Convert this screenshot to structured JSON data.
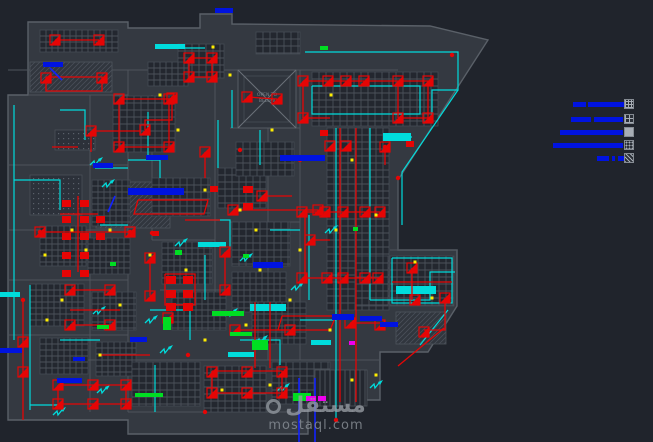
{
  "watermark": {
    "logo": "مستقل",
    "url": "mostaql.com"
  },
  "void_label": {
    "line1": "OPEN TO",
    "line2": "BELOW"
  },
  "palette": {
    "bg": "#20242c",
    "building": "#343941",
    "wall": "#5a6068",
    "wall_dim": "#4e545c",
    "grid_fill": "#23272f",
    "grid_line": "#4b515a",
    "red": "#e60505",
    "cyan": "#00dcdc",
    "blue": "#0013e0",
    "yellow": "#ffee00",
    "green": "#00dd22",
    "magenta": "#ee00ee",
    "gray_text": "#788089"
  },
  "legend": {
    "rows": [
      {
        "bars": [
          [
            573,
            102,
            13,
            5
          ],
          [
            588,
            102,
            36,
            5
          ]
        ],
        "swatch": {
          "x": 624,
          "y": 99,
          "pattern": "fine-grid"
        }
      },
      {
        "bars": [
          [
            571,
            117,
            20,
            5
          ],
          [
            594,
            117,
            29,
            5
          ]
        ],
        "swatch": {
          "x": 624,
          "y": 114,
          "pattern": "coarse-grid"
        }
      },
      {
        "bars": [
          [
            560,
            130,
            63,
            5
          ]
        ],
        "swatch": {
          "x": 624,
          "y": 127,
          "pattern": "solid"
        }
      },
      {
        "bars": [
          [
            553,
            143,
            70,
            5
          ]
        ],
        "swatch": {
          "x": 624,
          "y": 140,
          "pattern": "speckle"
        }
      },
      {
        "bars": [
          [
            597,
            156,
            12,
            5
          ],
          [
            612,
            156,
            3,
            5
          ],
          [
            618,
            156,
            12,
            5
          ]
        ],
        "swatch": {
          "x": 624,
          "y": 153,
          "pattern": "diag"
        }
      }
    ]
  },
  "drawing": {
    "building": [
      {
        "pts": "28,22 128,22 128,28 200,28 200,14 232,14 232,24 430,26 488,40 398,180 398,250 457,250 457,306 428,352 380,352 380,400 308,400 308,434 128,434 128,420 8,420 8,95 28,95"
      }
    ],
    "walls": [
      [
        128,
        70,
        128,
        412
      ],
      [
        90,
        95,
        90,
        412
      ],
      [
        152,
        95,
        152,
        240
      ],
      [
        215,
        70,
        215,
        300
      ],
      [
        268,
        128,
        268,
        360
      ],
      [
        300,
        70,
        300,
        360
      ],
      [
        8,
        165,
        128,
        165
      ],
      [
        8,
        230,
        128,
        230
      ],
      [
        8,
        280,
        128,
        280
      ],
      [
        8,
        335,
        128,
        335
      ],
      [
        60,
        360,
        380,
        360
      ],
      [
        128,
        412,
        300,
        412
      ],
      [
        152,
        240,
        215,
        240
      ],
      [
        230,
        128,
        300,
        128
      ],
      [
        230,
        222,
        300,
        222
      ],
      [
        160,
        290,
        230,
        290
      ],
      [
        8,
        70,
        398,
        70
      ],
      [
        28,
        95,
        128,
        95
      ],
      [
        398,
        180,
        398,
        250
      ],
      [
        390,
        250,
        457,
        250
      ]
    ],
    "grids": [
      [
        40,
        30,
        78,
        22,
        6
      ],
      [
        178,
        44,
        46,
        34,
        7
      ],
      [
        256,
        32,
        44,
        22,
        7
      ],
      [
        148,
        62,
        40,
        24,
        6
      ],
      [
        312,
        72,
        126,
        54,
        7
      ],
      [
        327,
        128,
        62,
        182,
        7
      ],
      [
        390,
        256,
        64,
        50,
        7
      ],
      [
        355,
        256,
        33,
        50,
        7
      ],
      [
        113,
        96,
        62,
        56,
        7
      ],
      [
        92,
        180,
        38,
        46,
        6
      ],
      [
        40,
        226,
        46,
        40,
        6
      ],
      [
        88,
        238,
        42,
        36,
        6
      ],
      [
        30,
        284,
        54,
        42,
        6
      ],
      [
        92,
        292,
        44,
        38,
        6
      ],
      [
        40,
        338,
        48,
        36,
        6
      ],
      [
        96,
        342,
        40,
        34,
        6
      ],
      [
        152,
        178,
        58,
        38,
        7
      ],
      [
        218,
        168,
        48,
        40,
        7
      ],
      [
        236,
        142,
        58,
        34,
        7
      ],
      [
        232,
        222,
        58,
        44,
        7
      ],
      [
        162,
        242,
        50,
        42,
        6
      ],
      [
        232,
        272,
        54,
        40,
        6
      ],
      [
        172,
        292,
        54,
        38,
        6
      ],
      [
        252,
        302,
        54,
        42,
        6
      ],
      [
        132,
        362,
        68,
        44,
        7
      ],
      [
        204,
        366,
        62,
        46,
        7
      ],
      [
        272,
        362,
        58,
        42,
        7
      ]
    ],
    "hatches": [
      [
        96,
        182,
        74,
        46
      ],
      [
        30,
        62,
        82,
        30
      ],
      [
        396,
        312,
        50,
        32
      ]
    ],
    "dotregions": [
      [
        30,
        175,
        52,
        40
      ],
      [
        55,
        130,
        40,
        20
      ]
    ],
    "stripes": [
      [
        315,
        370,
        52,
        36
      ]
    ],
    "xroom": {
      "x": 238,
      "y": 70,
      "w": 58,
      "h": 58
    },
    "redlines": [
      "55,40 99,40",
      "46,77 102,77 102,91 46,91 46,77",
      "119,99 169,99 169,147 119,147 119,99",
      "189,58 212,58 212,77 189,77 189,58",
      "303,81 432,81",
      "303,81 303,118",
      "398,81 398,118",
      "428,81 428,118",
      "303,118 330,118",
      "398,118 428,118",
      "340,128 340,402",
      "356,128 356,402",
      "302,212 380,212",
      "302,278 380,278",
      "305,212 305,278",
      "172,98 172,120 145,120 145,130",
      "92,131 140,131",
      "40,232 130,232",
      "78,196 78,272",
      "60,214 98,214",
      "58,385 126,385 126,404 58,404 58,385",
      "212,371 282,371 282,393 212,393 212,371",
      "23,300 23,420",
      "247,97 277,99",
      "233,210 318,210",
      "165,274 195,274 195,305 165,305 165,274",
      "398,366 444,328",
      "412,268 412,300",
      "392,282 452,282",
      "52,147 78,147",
      "150,258 150,296",
      "205,152 205,178",
      "262,196 292,196",
      "70,310 120,310",
      "100,355 150,355",
      "235,330 290,330",
      "310,240 330,240",
      "225,252 225,290",
      "185,220 220,220",
      "445,298 445,330 424,330",
      "350,323 382,323",
      "255,302 255,368",
      "270,302 270,368",
      "138,200 208,200 204,214 134,214 138,200",
      "282,316 336,316 330,330 278,330 282,316",
      "70,290 110,290",
      "70,325 110,325",
      "91,131 91,152",
      "385,147 385,165"
    ],
    "fixtures": [
      [
        55,
        40
      ],
      [
        99,
        40
      ],
      [
        46,
        78
      ],
      [
        102,
        78
      ],
      [
        119,
        99
      ],
      [
        169,
        99
      ],
      [
        119,
        147
      ],
      [
        169,
        147
      ],
      [
        189,
        58
      ],
      [
        212,
        58
      ],
      [
        189,
        77
      ],
      [
        212,
        77
      ],
      [
        303,
        81
      ],
      [
        328,
        81
      ],
      [
        346,
        81
      ],
      [
        364,
        81
      ],
      [
        398,
        81
      ],
      [
        428,
        81
      ],
      [
        303,
        118
      ],
      [
        398,
        118
      ],
      [
        428,
        118
      ],
      [
        330,
        146
      ],
      [
        346,
        146
      ],
      [
        302,
        212
      ],
      [
        325,
        212
      ],
      [
        343,
        212
      ],
      [
        365,
        212
      ],
      [
        380,
        212
      ],
      [
        302,
        278
      ],
      [
        327,
        278
      ],
      [
        343,
        278
      ],
      [
        365,
        278
      ],
      [
        378,
        278
      ],
      [
        412,
        268
      ],
      [
        415,
        300
      ],
      [
        445,
        298
      ],
      [
        424,
        332
      ],
      [
        350,
        323
      ],
      [
        380,
        325
      ],
      [
        172,
        98
      ],
      [
        145,
        130
      ],
      [
        91,
        131
      ],
      [
        247,
        97
      ],
      [
        277,
        99
      ],
      [
        70,
        290
      ],
      [
        110,
        290
      ],
      [
        70,
        325
      ],
      [
        110,
        325
      ],
      [
        58,
        385
      ],
      [
        93,
        385
      ],
      [
        126,
        385
      ],
      [
        58,
        404
      ],
      [
        93,
        404
      ],
      [
        126,
        404
      ],
      [
        212,
        372
      ],
      [
        247,
        372
      ],
      [
        282,
        372
      ],
      [
        212,
        393
      ],
      [
        247,
        393
      ],
      [
        282,
        393
      ],
      [
        205,
        152
      ],
      [
        262,
        196
      ],
      [
        150,
        258
      ],
      [
        150,
        296
      ],
      [
        225,
        252
      ],
      [
        225,
        290
      ],
      [
        310,
        240
      ],
      [
        290,
        330
      ],
      [
        235,
        330
      ],
      [
        23,
        342
      ],
      [
        23,
        372
      ],
      [
        40,
        232
      ],
      [
        130,
        232
      ],
      [
        385,
        147
      ],
      [
        168,
        318
      ],
      [
        233,
        210
      ],
      [
        318,
        210
      ]
    ],
    "panels": [
      [
        62,
        200,
        9,
        7
      ],
      [
        80,
        200,
        9,
        7
      ],
      [
        62,
        216,
        9,
        7
      ],
      [
        80,
        216,
        9,
        7
      ],
      [
        96,
        216,
        9,
        7
      ],
      [
        62,
        233,
        9,
        7
      ],
      [
        80,
        233,
        9,
        7
      ],
      [
        96,
        233,
        9,
        7
      ],
      [
        62,
        252,
        9,
        7
      ],
      [
        80,
        252,
        9,
        7
      ],
      [
        62,
        270,
        9,
        7
      ],
      [
        80,
        270,
        9,
        7
      ],
      [
        166,
        276,
        10,
        8
      ],
      [
        183,
        276,
        10,
        8
      ],
      [
        166,
        290,
        10,
        8
      ],
      [
        183,
        290,
        10,
        8
      ],
      [
        166,
        303,
        10,
        8
      ],
      [
        183,
        303,
        10,
        8
      ],
      [
        243,
        186,
        10,
        7
      ],
      [
        243,
        203,
        10,
        7
      ],
      [
        320,
        130,
        8,
        6
      ],
      [
        406,
        141,
        8,
        6
      ],
      [
        152,
        231,
        7,
        5
      ],
      [
        210,
        186,
        8,
        6
      ]
    ],
    "cyanlines": [
      "305,52 458,52 458,90 432,90 432,120",
      "458,90 402,172 402,225",
      "312,86 420,86 420,114 312,114 312,86",
      "336,128 336,400",
      "370,128 370,300",
      "370,300 430,300 430,272 455,272",
      "392,258 452,258 452,303 392,303 392,258",
      "14,105 14,340",
      "30,285 30,410",
      "14,180 60,180 60,210",
      "128,160 160,160 160,178",
      "95,168 128,168",
      "148,112 148,160",
      "218,120 218,168",
      "260,130 260,165",
      "200,220 230,220 230,250",
      "150,310 190,310 190,340",
      "60,340 100,340",
      "240,340 280,340 280,365",
      "300,320 336,320",
      "386,137 412,137",
      "60,110 85,110 85,140",
      "175,48 205,48",
      "100,225 128,225",
      "309,215 309,300",
      "448,310 420,345",
      "270,230 300,230",
      "155,365 155,412",
      "30,405 58,405",
      "205,255 205,300",
      "336,400 336,420",
      "232,90 232,128"
    ],
    "cyanbars": [
      [
        383,
        133,
        28,
        8
      ],
      [
        396,
        286,
        40,
        8
      ],
      [
        250,
        304,
        36,
        7
      ],
      [
        198,
        242,
        28,
        5
      ],
      [
        311,
        340,
        20,
        5
      ],
      [
        0,
        292,
        20,
        5
      ],
      [
        155,
        44,
        30,
        5
      ],
      [
        228,
        352,
        26,
        5
      ]
    ],
    "squiggles": [
      [
        107,
        184
      ],
      [
        180,
        243
      ],
      [
        245,
        258
      ],
      [
        296,
        287
      ],
      [
        330,
        230
      ],
      [
        98,
        311
      ],
      [
        150,
        320
      ],
      [
        230,
        313
      ],
      [
        375,
        385
      ],
      [
        282,
        388
      ],
      [
        102,
        390
      ],
      [
        58,
        412
      ],
      [
        165,
        350
      ],
      [
        260,
        340
      ],
      [
        95,
        162
      ]
    ],
    "bluebars": [
      [
        43,
        62,
        20,
        5
      ],
      [
        128,
        188,
        56,
        7
      ],
      [
        146,
        155,
        22,
        5
      ],
      [
        93,
        163,
        20,
        5
      ],
      [
        280,
        155,
        45,
        6
      ],
      [
        332,
        314,
        22,
        6
      ],
      [
        360,
        316,
        22,
        5
      ],
      [
        380,
        322,
        18,
        5
      ],
      [
        0,
        348,
        22,
        5
      ],
      [
        73,
        357,
        12,
        4
      ],
      [
        57,
        378,
        25,
        5
      ],
      [
        130,
        337,
        17,
        5
      ],
      [
        215,
        8,
        18,
        5
      ],
      [
        253,
        262,
        30,
        6
      ]
    ],
    "bluelines": [
      "299,378 299,442",
      "315,378 315,442",
      "50,68 62,80",
      "115,196 108,212"
    ],
    "yellowdots": [
      [
        213,
        47
      ],
      [
        230,
        75
      ],
      [
        331,
        95
      ],
      [
        272,
        130
      ],
      [
        352,
        160
      ],
      [
        376,
        215
      ],
      [
        336,
        230
      ],
      [
        300,
        250
      ],
      [
        62,
        300
      ],
      [
        100,
        355
      ],
      [
        246,
        325
      ],
      [
        352,
        380
      ],
      [
        376,
        375
      ],
      [
        270,
        385
      ],
      [
        222,
        390
      ],
      [
        120,
        305
      ],
      [
        47,
        320
      ],
      [
        150,
        255
      ],
      [
        186,
        270
      ],
      [
        205,
        190
      ],
      [
        256,
        230
      ],
      [
        290,
        300
      ],
      [
        432,
        298
      ],
      [
        415,
        262
      ],
      [
        86,
        250
      ],
      [
        178,
        130
      ],
      [
        160,
        95
      ],
      [
        240,
        210
      ],
      [
        330,
        330
      ],
      [
        205,
        340
      ],
      [
        260,
        270
      ],
      [
        110,
        230
      ],
      [
        72,
        230
      ],
      [
        45,
        255
      ]
    ],
    "greens": [
      [
        175,
        250,
        7,
        5
      ],
      [
        243,
        254,
        6,
        4
      ],
      [
        212,
        311,
        32,
        5
      ],
      [
        230,
        332,
        22,
        4
      ],
      [
        252,
        340,
        16,
        10
      ],
      [
        163,
        317,
        8,
        13
      ],
      [
        97,
        325,
        12,
        4
      ],
      [
        135,
        393,
        28,
        4
      ],
      [
        293,
        393,
        18,
        8
      ],
      [
        320,
        46,
        8,
        4
      ],
      [
        353,
        227,
        5,
        4
      ],
      [
        110,
        262,
        6,
        4
      ]
    ],
    "magentas": [
      [
        306,
        396,
        10,
        5
      ],
      [
        318,
        396,
        8,
        5
      ],
      [
        349,
        341,
        6,
        4
      ]
    ],
    "reddots": [
      [
        152,
        233
      ],
      [
        40,
        232
      ],
      [
        240,
        150
      ],
      [
        385,
        147
      ],
      [
        300,
        160
      ],
      [
        23,
        300
      ],
      [
        130,
        232
      ],
      [
        188,
        355
      ],
      [
        398,
        178
      ],
      [
        452,
        55
      ],
      [
        336,
        420
      ],
      [
        205,
        412
      ]
    ]
  }
}
